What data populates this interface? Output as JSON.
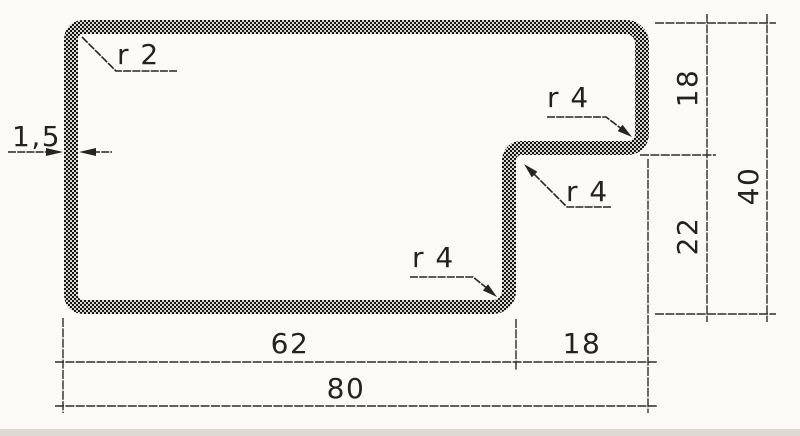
{
  "drawing": {
    "type": "technical-profile-cross-section",
    "callouts": {
      "wall_thickness": "1,5",
      "radius_top_left": "r 2",
      "radius_hook_inner": "r 4",
      "radius_step_top": "r 4",
      "radius_step_bottom": "r 4"
    },
    "dimensions": {
      "height_top": "18",
      "height_bottom": "22",
      "height_total": "40",
      "width_left": "62",
      "width_right": "18",
      "width_total": "80"
    },
    "colors": {
      "paper": "#fbfaf7",
      "line": "#2e2c28",
      "band_dark": "#16150f",
      "band_light": "#d8d7d1"
    }
  }
}
